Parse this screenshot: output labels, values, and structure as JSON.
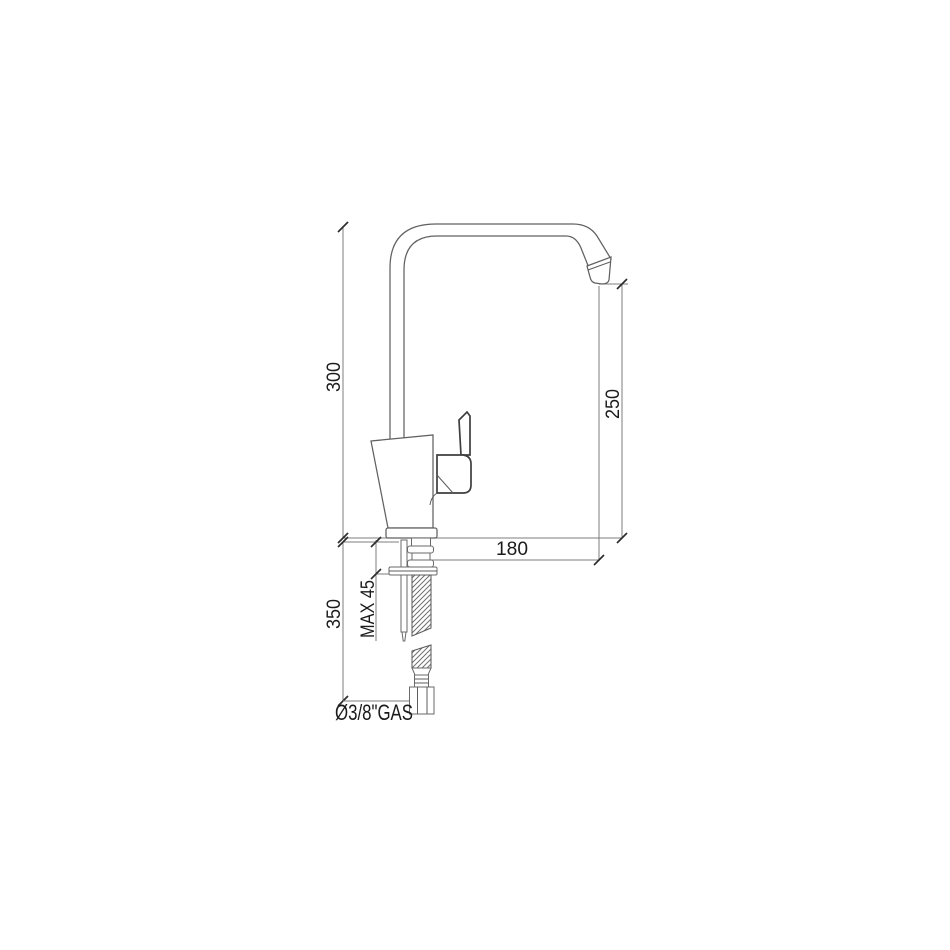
{
  "diagram": {
    "type": "technical-drawing",
    "subject": "single-lever kitchen mixer tap, side elevation with installation dimensions",
    "units": "mm",
    "dimensions": {
      "total_height": {
        "label": "300",
        "orientation": "vertical",
        "value": 300
      },
      "outlet_height": {
        "label": "250",
        "orientation": "vertical",
        "value": 250
      },
      "spout_reach": {
        "label": "180",
        "orientation": "horizontal",
        "value": 180
      },
      "max_deck_thickness": {
        "label": "MAX 45",
        "orientation": "vertical",
        "value": 45
      },
      "hose_length": {
        "label": "350",
        "orientation": "vertical",
        "value": 350
      },
      "connection_thread": {
        "label": "Ø3/8\"GAS"
      }
    },
    "colors": {
      "background": "#ffffff",
      "drawing_line": "#616161",
      "dimension_line": "#7c7c7c",
      "text": "#1b1b1b"
    }
  }
}
